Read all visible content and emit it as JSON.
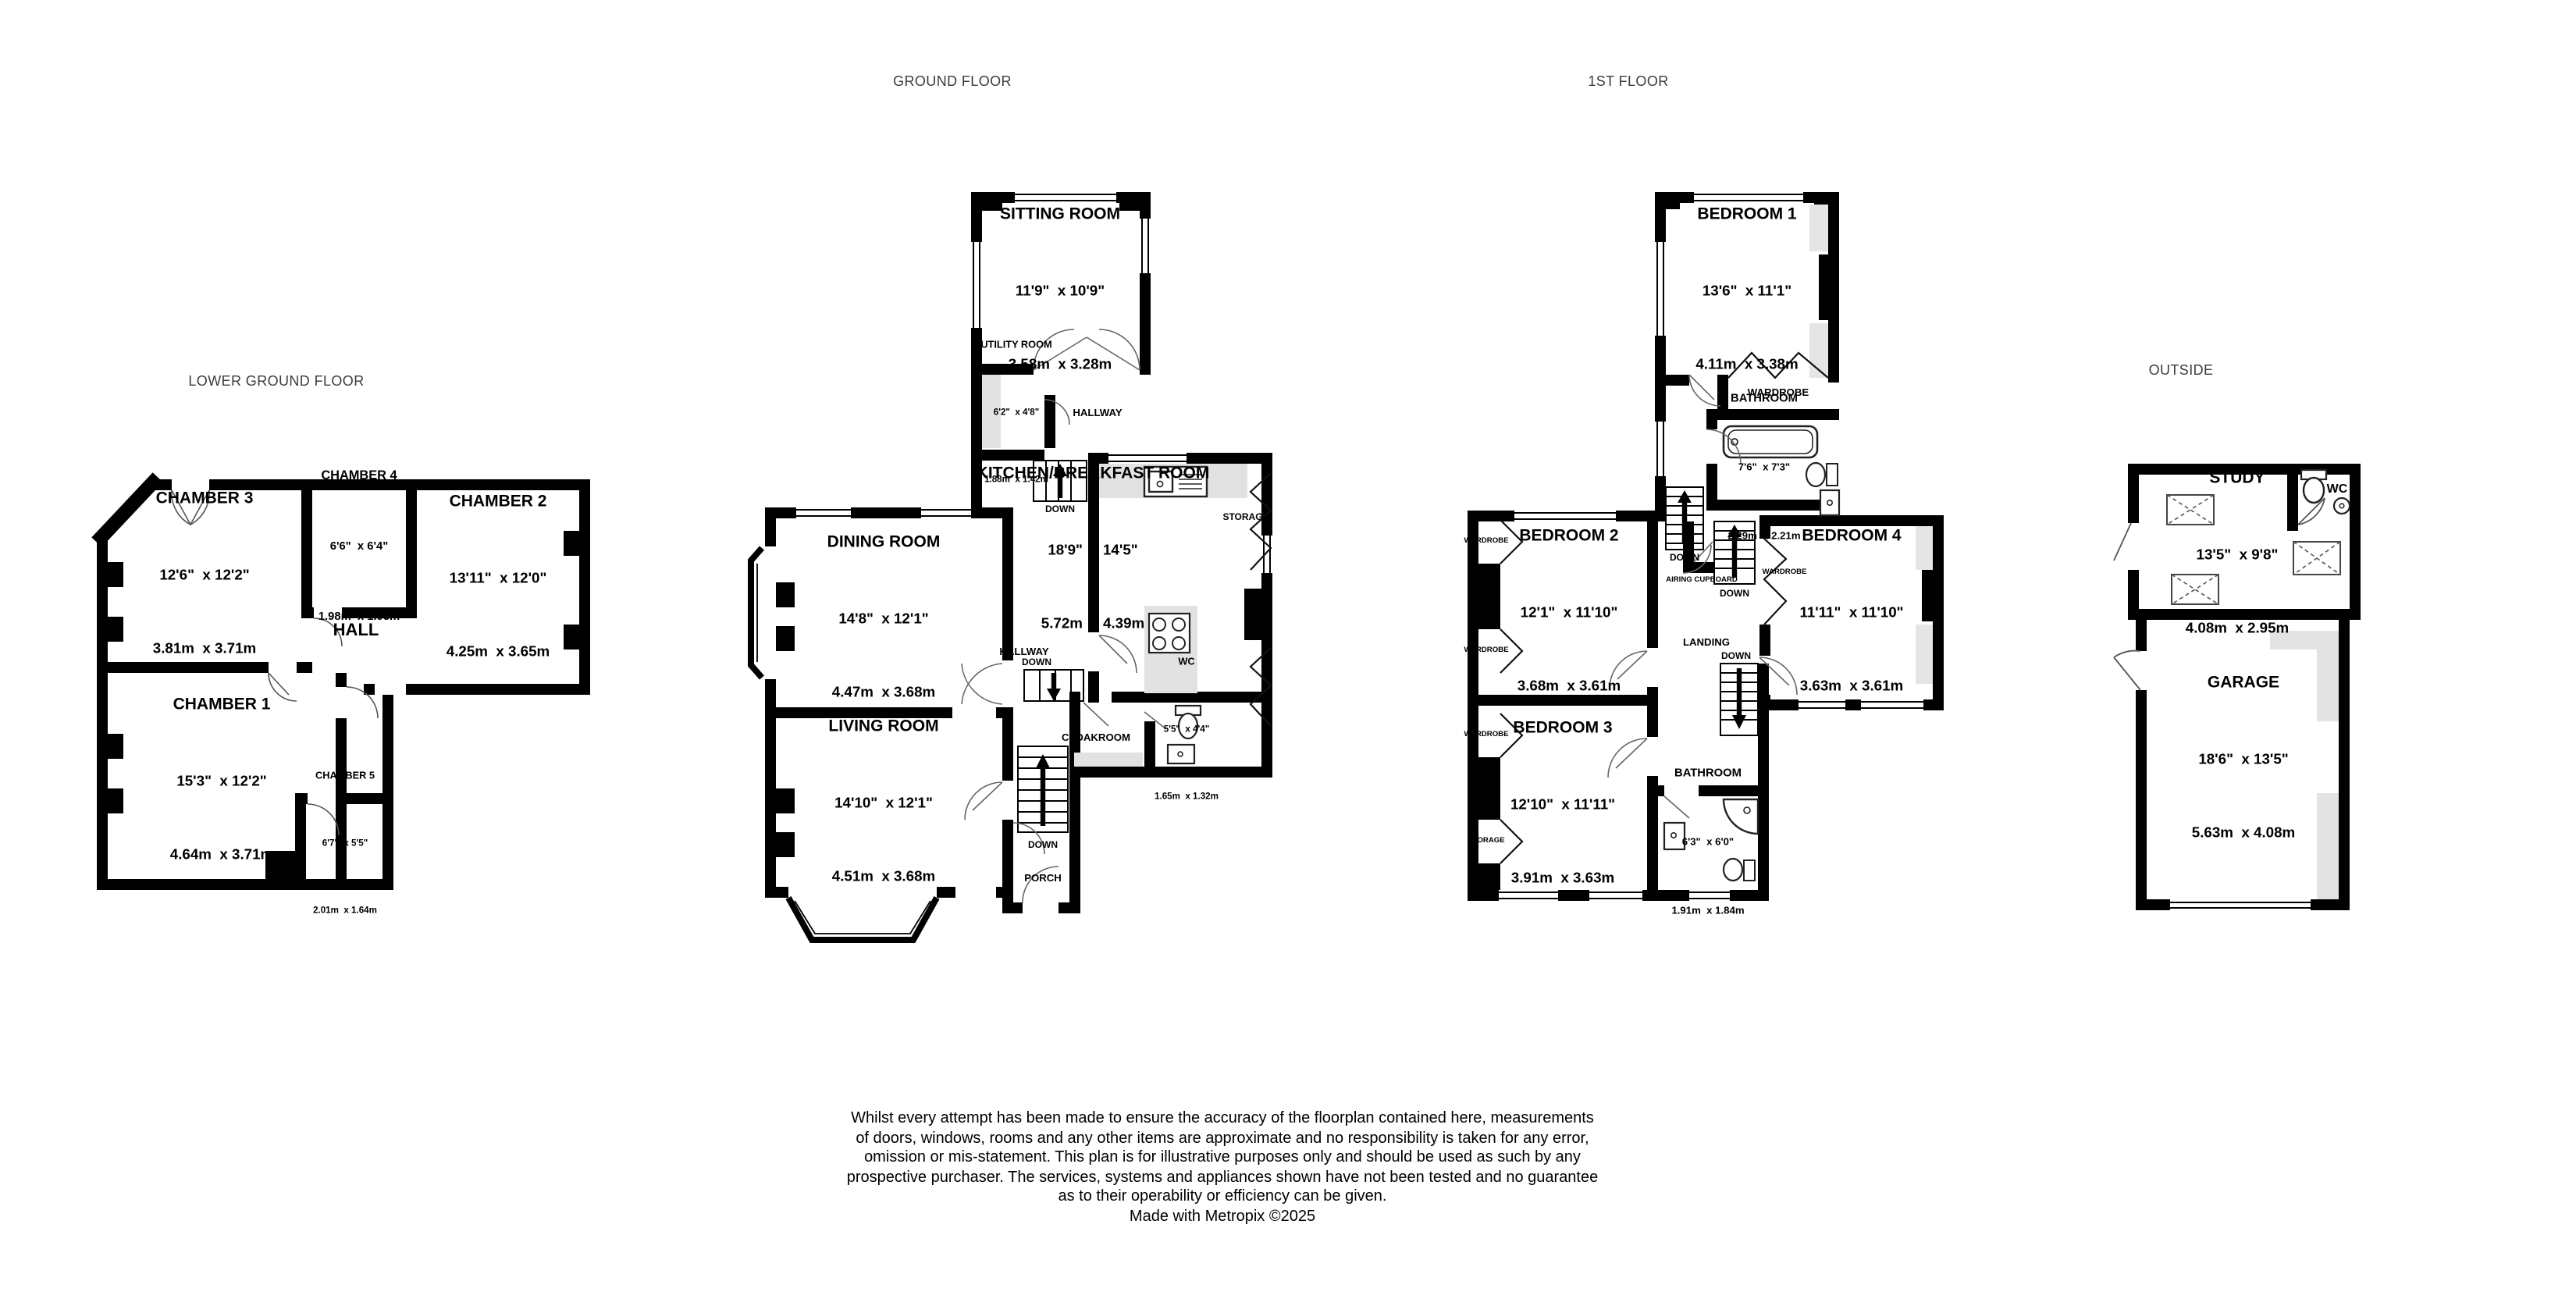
{
  "titles": {
    "lower_ground": "LOWER GROUND FLOOR",
    "ground": "GROUND FLOOR",
    "first": "1ST FLOOR",
    "outside": "OUTSIDE"
  },
  "lower_ground": {
    "rooms": {
      "chamber3": {
        "name": "CHAMBER 3",
        "imperial": "12'6\"  x 12'2\"",
        "metric": "3.81m  x 3.71m"
      },
      "chamber4": {
        "name": "CHAMBER 4",
        "imperial": "6'6\"  x 6'4\"",
        "metric": "1.98m  x 1.93m"
      },
      "chamber2": {
        "name": "CHAMBER 2",
        "imperial": "13'11\"  x 12'0\"",
        "metric": "4.25m  x 3.65m"
      },
      "chamber1": {
        "name": "CHAMBER 1",
        "imperial": "15'3\"  x 12'2\"",
        "metric": "4.64m  x 3.71m"
      },
      "chamber5": {
        "name": "CHAMBER 5",
        "imperial": "6'7\"  x 5'5\"",
        "metric": "2.01m  x 1.64m"
      }
    },
    "labels": {
      "hall": "HALL"
    }
  },
  "ground": {
    "rooms": {
      "sitting": {
        "name": "SITTING ROOM",
        "imperial": "11'9\"  x 10'9\"",
        "metric": "3.58m  x 3.28m"
      },
      "utility": {
        "name": "UTILITY ROOM",
        "imperial": "6'2\"  x 4'8\"",
        "metric": "1.88m  x 1.42m"
      },
      "kitchen": {
        "name": "KITCHEN/BREAKFAST ROOM",
        "imperial": "18'9\"  x 14'5\"",
        "metric": "5.72m  x 4.39m"
      },
      "dining": {
        "name": "DINING ROOM",
        "imperial": "14'8\"  x 12'1\"",
        "metric": "4.47m  x 3.68m"
      },
      "living": {
        "name": "LIVING ROOM",
        "imperial": "14'10\"  x 12'1\"",
        "metric": "4.51m  x 3.68m"
      },
      "wc": {
        "name": "WC",
        "imperial": "5'5\"  x 4'4\"",
        "metric": "1.65m  x 1.32m"
      }
    },
    "labels": {
      "hallway_top": "HALLWAY",
      "hallway_mid": "HALLWAY",
      "down_top": "DOWN",
      "down_mid": "DOWN",
      "down_bottom": "DOWN",
      "storage": "STORAGE",
      "cloakroom": "CLOAKROOM",
      "porch": "PORCH"
    }
  },
  "first": {
    "rooms": {
      "bedroom1": {
        "name": "BEDROOM 1",
        "imperial": "13'6\"  x 11'1\"",
        "metric": "4.11m  x 3.38m"
      },
      "bathroom_top": {
        "name": "BATHROOM",
        "imperial": "7'6\"  x 7'3\"",
        "metric": "2.29m  x 2.21m"
      },
      "bedroom2": {
        "name": "BEDROOM 2",
        "imperial": "12'1\"  x 11'10\"",
        "metric": "3.68m  x 3.61m"
      },
      "bedroom4": {
        "name": "BEDROOM 4",
        "imperial": "11'11\"  x 11'10\"",
        "metric": "3.63m  x 3.61m"
      },
      "bedroom3": {
        "name": "BEDROOM 3",
        "imperial": "12'10\"  x 11'11\"",
        "metric": "3.91m  x 3.63m"
      },
      "bathroom_bottom": {
        "name": "BATHROOM",
        "imperial": "6'3\"  x 6'0\"",
        "metric": "1.91m  x 1.84m"
      }
    },
    "labels": {
      "wardrobe_bed1": "WARDROBE",
      "wardrobe_1": "WARDROBE",
      "wardrobe_2": "WARDROBE",
      "wardrobe_3": "WARDROBE",
      "wardrobe_bed4": "WARDROBE",
      "storage": "STORAGE",
      "airing": "AIRING CUPBOARD",
      "landing": "LANDING",
      "down_left": "DOWN",
      "down_mid": "DOWN",
      "down_landing": "DOWN"
    }
  },
  "outside": {
    "rooms": {
      "study": {
        "name": "STUDY",
        "imperial": "13'5\"  x 9'8\"",
        "metric": "4.08m  x 2.95m"
      },
      "garage": {
        "name": "GARAGE",
        "imperial": "18'6\"  x 13'5\"",
        "metric": "5.63m  x 4.08m"
      }
    },
    "labels": {
      "wc": "WC"
    }
  },
  "disclaimer": {
    "lines": [
      "Whilst every attempt has been made to ensure the accuracy of the floorplan contained here, measurements",
      "of doors, windows, rooms and any other items are approximate and no responsibility is taken for any error,",
      "omission or mis-statement. This plan is for illustrative purposes only and should be used as such by any",
      "prospective purchaser. The services, systems and appliances shown have not been tested and no guarantee",
      "as to their operability or efficiency can be given."
    ],
    "credit": "Made with Metropix ©2025"
  }
}
